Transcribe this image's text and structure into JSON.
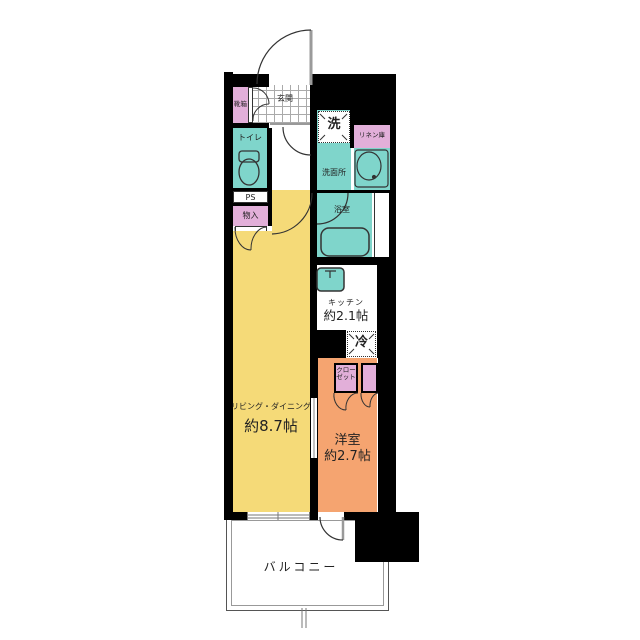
{
  "plan": {
    "type": "floor-plan",
    "colors": {
      "wall": "#000000",
      "wet_area_teal": "#7FD5CB",
      "storage_pink": "#E2AFD9",
      "living_yellow": "#F5DA78",
      "bedroom_orange": "#F5A470"
    },
    "rooms": {
      "genkan": {
        "label": "玄関"
      },
      "shoe_box": {
        "label": "靴箱"
      },
      "toilet": {
        "label": "トイレ"
      },
      "pipe_space": {
        "label": "PS"
      },
      "storage": {
        "label": "物入"
      },
      "washer": {
        "label": "洗"
      },
      "linen": {
        "label": "リネン庫"
      },
      "washroom": {
        "label": "洗面所"
      },
      "bathroom": {
        "label": "浴室"
      },
      "kitchen": {
        "label": "キッチン",
        "size": "約2.1帖"
      },
      "fridge": {
        "label": "冷"
      },
      "closet": {
        "label_line1": "クロー",
        "label_line2": "ゼット"
      },
      "living_dining": {
        "label": "リビング・ダイニング",
        "size": "約8.7帖"
      },
      "bedroom": {
        "label": "洋室",
        "size": "約2.7帖"
      },
      "balcony": {
        "label": "バルコニー"
      }
    }
  }
}
